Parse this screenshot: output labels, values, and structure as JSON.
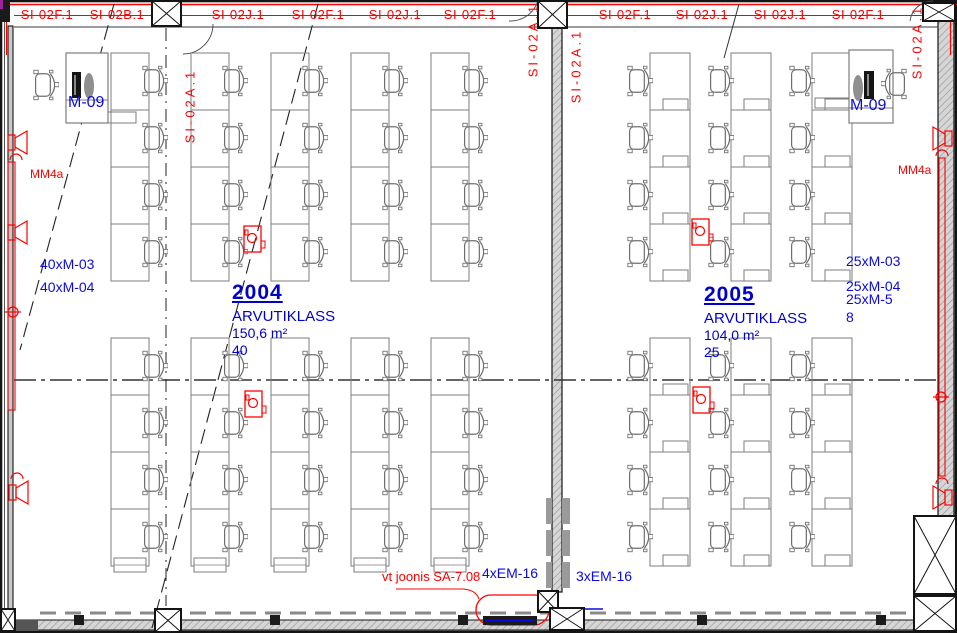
{
  "colors": {
    "annotation_red": "#ff0000",
    "annotation_blue": "#0b0be0",
    "room_label_blue": "#0000cc",
    "wall_black": "#141414",
    "furniture_gray": "#7d7d7d"
  },
  "wall_labels_top": [
    {
      "text": "SI-02F.1",
      "x": 47
    },
    {
      "text": "SI-02B.1",
      "x": 117
    },
    {
      "text": "SI-02J.1",
      "x": 238
    },
    {
      "text": "SI-02F.1",
      "x": 318
    },
    {
      "text": "SI-02J.1",
      "x": 395
    },
    {
      "text": "SI-02F.1",
      "x": 470
    },
    {
      "text": "SI-02F.1",
      "x": 625
    },
    {
      "text": "SI-02J.1",
      "x": 702
    },
    {
      "text": "SI-02J.1",
      "x": 780
    },
    {
      "text": "SI-02F.1",
      "x": 858
    }
  ],
  "wall_labels_vertical": [
    {
      "text": "SI-02A.1",
      "x": 190,
      "y": 106
    },
    {
      "text": "SI-02A.1",
      "x": 533,
      "y": 40
    },
    {
      "text": "SI-02A.1",
      "x": 576,
      "y": 66
    },
    {
      "text": "SI-02A.1",
      "x": 917,
      "y": 42
    }
  ],
  "rooms": [
    {
      "number": "2004",
      "name": "ARVUTIKLASS",
      "area": "150,6 m²",
      "capacity": "40"
    },
    {
      "number": "2005",
      "name": "ARVUTIKLASS",
      "area": "104,0 m²",
      "capacity": "25"
    }
  ],
  "equipment_labels": [
    {
      "text": "M-09",
      "x": 68,
      "y": 95,
      "cls": "lbl-m09",
      "name": "teacher-station-label-left"
    },
    {
      "text": "M-09",
      "x": 850,
      "y": 98,
      "cls": "lbl-m09",
      "name": "teacher-station-label-right"
    },
    {
      "text": "40xM-03",
      "x": 40,
      "y": 257,
      "cls": "lbl-blue",
      "name": "furniture-count-label"
    },
    {
      "text": "40xM-04",
      "x": 40,
      "y": 280,
      "cls": "lbl-blue",
      "name": "furniture-count-label"
    },
    {
      "text": "25xM-03",
      "x": 846,
      "y": 254,
      "cls": "lbl-blue",
      "name": "furniture-count-label"
    },
    {
      "text": "25xM-04",
      "x": 846,
      "y": 279,
      "cls": "lbl-blue",
      "name": "furniture-count-label"
    },
    {
      "text": "25xM-5",
      "x": 846,
      "y": 292,
      "cls": "lbl-blue",
      "name": "furniture-count-label"
    },
    {
      "text": "8",
      "x": 846,
      "y": 310,
      "cls": "lbl-blue",
      "name": "furniture-count-label"
    },
    {
      "text": "4xEM-16",
      "x": 482,
      "y": 566,
      "cls": "lbl-blue",
      "name": "socket-count-label"
    },
    {
      "text": "3xEM-16",
      "x": 576,
      "y": 569,
      "cls": "lbl-blue",
      "name": "socket-count-label"
    }
  ],
  "red_notes": [
    {
      "text": "MM4a",
      "x": 30,
      "y": 168,
      "cls": "lbl-red",
      "name": "mm4a-note-left"
    },
    {
      "text": "MM4a",
      "x": 898,
      "y": 164,
      "cls": "lbl-red",
      "name": "mm4a-note-right"
    },
    {
      "text": "vt joonis SA-7.08",
      "x": 382,
      "y": 570,
      "cls": "lbl-vt",
      "name": "reference-note"
    }
  ],
  "furniture": {
    "left_room": {
      "desk_columns": [
        111,
        191,
        271,
        351,
        431
      ],
      "desk_width": 38,
      "row_blocks": [
        {
          "y": 53,
          "count": 4,
          "pitch": 57
        },
        {
          "y": 338,
          "count": 4,
          "pitch": 57
        }
      ],
      "chair_side": "right",
      "cell_notch": false,
      "bottom_notch": true
    },
    "right_room": {
      "desk_columns": [
        650,
        731,
        812
      ],
      "desk_width": 40,
      "row_blocks": [
        {
          "y": 53,
          "count": 4,
          "pitch": 57
        },
        {
          "y": 338,
          "count": 4,
          "pitch": 57
        }
      ],
      "chair_side": "left",
      "cell_notch": true,
      "bottom_notch": false
    }
  },
  "projectors": [
    {
      "x": 244,
      "y": 226
    },
    {
      "x": 245,
      "y": 391
    },
    {
      "x": 692,
      "y": 219
    },
    {
      "x": 693,
      "y": 387
    }
  ]
}
